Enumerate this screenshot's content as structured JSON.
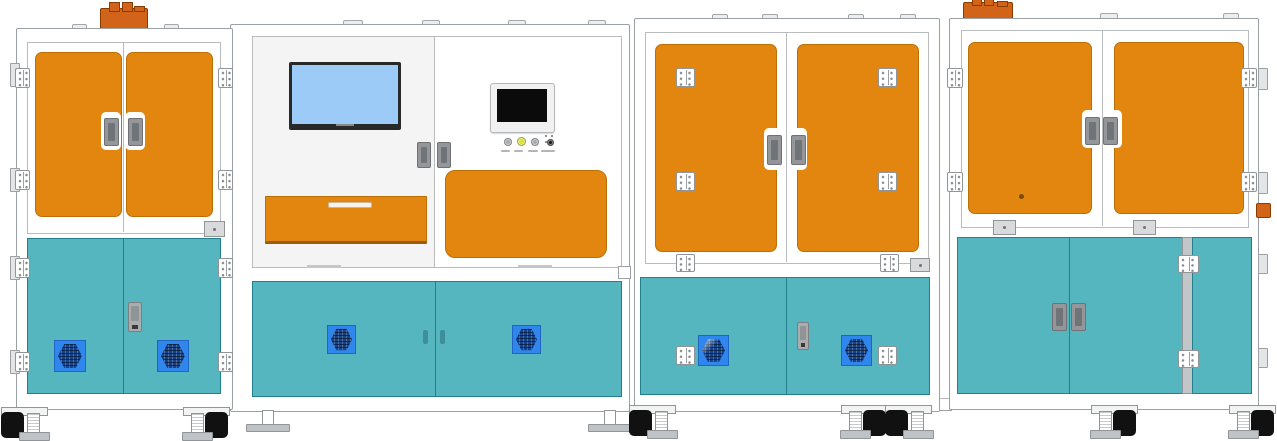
{
  "meta": {
    "description": "Front-view engineering illustration of a four-module automated production line",
    "canvas": {
      "width": 1277,
      "height": 441
    },
    "visible_text": "none (only illegible micro-labels under HMI push buttons)"
  },
  "colors": {
    "background": "#ffffff",
    "frame-border": "#9aa0a3",
    "panel-light": "#f4f4f4",
    "door-orange": "#e2860f",
    "door-orange-border": "#bb7005",
    "device-orange": "#d2641a",
    "device-orange-border": "#8a3c00",
    "door-teal": "#55b6c0",
    "door-teal-border": "#23808d",
    "vent-blue": "#2f86ec",
    "fan-navy": "#15448c",
    "screen-blue": "#9ccbf8",
    "monitor-bezel": "#27292b",
    "hmi-face": "#f1f1f1",
    "hmi-screen": "#0b0b0b",
    "metal-gray": "#94969a",
    "metal-dark": "#6f7478",
    "button-yellow": "#e0e02e",
    "button-gray": "#a9abad",
    "button-black": "#1b1b1b",
    "foot-pad": "#c0c3c5",
    "caster-black": "#111111"
  },
  "modules": [
    {
      "id": "module-1",
      "name": "left cabinet",
      "upper": "two orange doors with center handles, side hinges",
      "lower": "two teal doors, two vent fans, center latch",
      "top_accessory": "orange terminal block",
      "feet": "two caster leveling feet"
    },
    {
      "id": "module-2",
      "name": "control station",
      "upper_left": "blue display monitor above orange drawer",
      "upper_right": "HMI panel, four push buttons, orange access panel",
      "lower": "two teal doors with two vent fans",
      "feet": "two T-shaped feet"
    },
    {
      "id": "module-3",
      "name": "process cabinet",
      "upper": "two orange doors with face-mounted hinges",
      "lower": "two teal doors, two vent fans, face hinges, center latch",
      "feet": "two caster leveling feet"
    },
    {
      "id": "module-4",
      "name": "right cabinet",
      "upper": "two orange doors with center handles, side hinges",
      "lower": "two teal doors plus narrow teal side panel on hinged strip",
      "top_accessory": "orange terminal block",
      "feet": "three caster leveling feet"
    }
  ],
  "hmi": {
    "buttons": [
      {
        "name": "push-button-1",
        "color_key": "button-gray"
      },
      {
        "name": "push-button-2",
        "color_key": "button-yellow"
      },
      {
        "name": "push-button-3",
        "color_key": "button-gray"
      },
      {
        "name": "push-button-4",
        "color_key": "button-black"
      }
    ],
    "button_labels_legible": false
  }
}
